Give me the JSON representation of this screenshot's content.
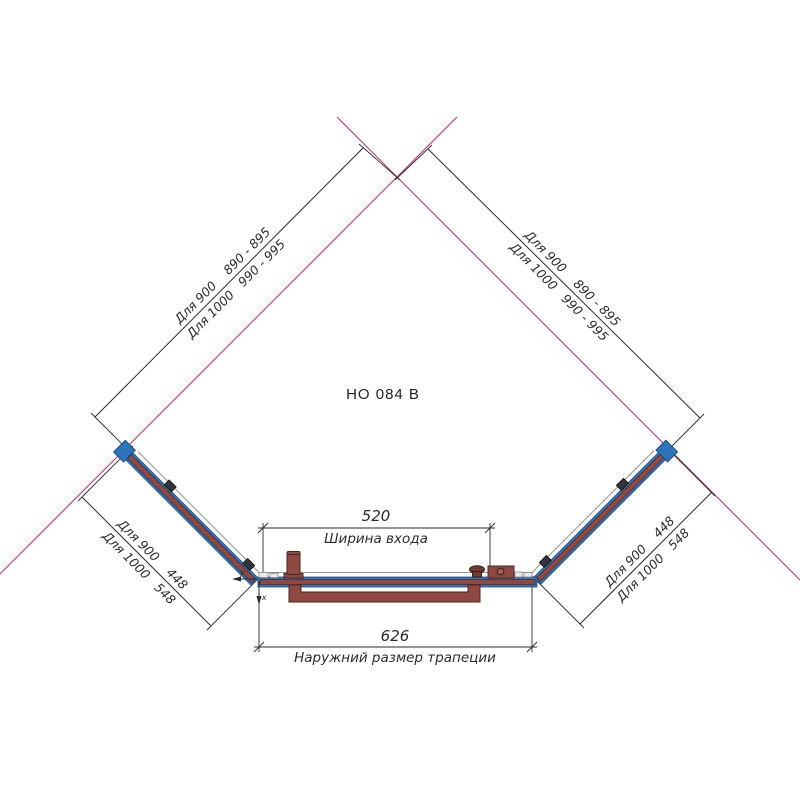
{
  "drawing": {
    "title": "HO 084 B",
    "dims": {
      "upper_left_l1": "Для 900    890 - 895",
      "upper_left_l2": "Для 1000   990 - 995",
      "upper_right_l1": "Для 900    890 - 895",
      "upper_right_l2": "Для 1000   990 - 995",
      "lower_left_l1": "Для 900    448",
      "lower_left_l2": "Для 1000   548",
      "lower_right_l1": "Для 900    448",
      "lower_right_l2": "Для 1000   548",
      "entrance_value": "520",
      "entrance_label": "Ширина входа",
      "outer_value": "626",
      "outer_label": "Наружний размер трапеции"
    },
    "axis": {
      "x": "x",
      "y": "y"
    },
    "colors": {
      "wall": "#b5366f",
      "glass": "#2e74b8",
      "profile": "#8e4a42",
      "line": "#2b2b2b",
      "edge": "#949494"
    }
  }
}
